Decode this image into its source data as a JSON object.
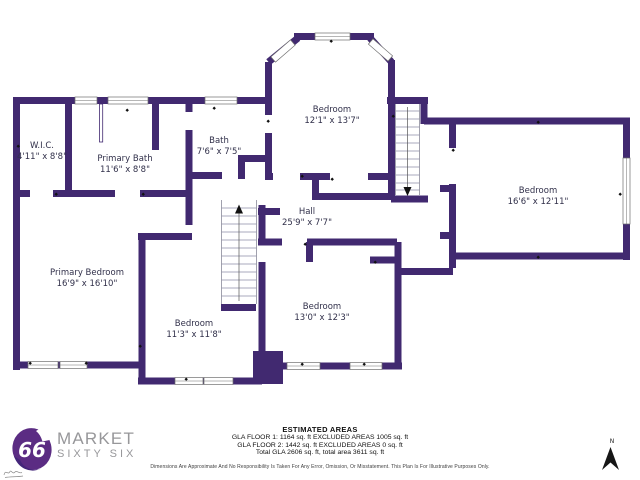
{
  "rooms": [
    {
      "name": "W.I.C.",
      "dims": "4'11\" x 8'8\""
    },
    {
      "name": "Primary Bath",
      "dims": "11'6\" x 8'8\""
    },
    {
      "name": "Bath",
      "dims": "7'6\" x 7'5\""
    },
    {
      "name": "Bedroom",
      "dims": "12'1\" x 13'7\""
    },
    {
      "name": "Bedroom",
      "dims": "16'6\" x 12'11\""
    },
    {
      "name": "Hall",
      "dims": "25'9\" x 7'7\""
    },
    {
      "name": "Primary Bedroom",
      "dims": "16'9\" x 16'10\""
    },
    {
      "name": "Bedroom",
      "dims": "11'3\" x 11'8\""
    },
    {
      "name": "Bedroom",
      "dims": "13'0\" x 12'3\""
    }
  ],
  "logo": {
    "monogram": "66",
    "brand_top": "MARKET",
    "brand_bottom": "SIXTY SIX"
  },
  "areas": {
    "title": "ESTIMATED AREAS",
    "lines": [
      "GLA FLOOR 1: 1164 sq. ft EXCLUDED AREAS 1005 sq. ft",
      "GLA FLOOR 2: 1442 sq. ft EXCLUDED AREAS 0 sq. ft",
      "Total GLA 2606 sq. ft, total area 3611 sq. ft"
    ]
  },
  "disclaimer": "Dimensions Are Approximate And No Responsibility Is Taken For Any Error, Omission, Or Misstatement. This Plan Is For Illustrative Purposes Only.",
  "compass": {
    "label": "N"
  },
  "colors": {
    "wall": "#412970",
    "brand_purple": "#5b2c83",
    "label_text": "#31304a"
  }
}
